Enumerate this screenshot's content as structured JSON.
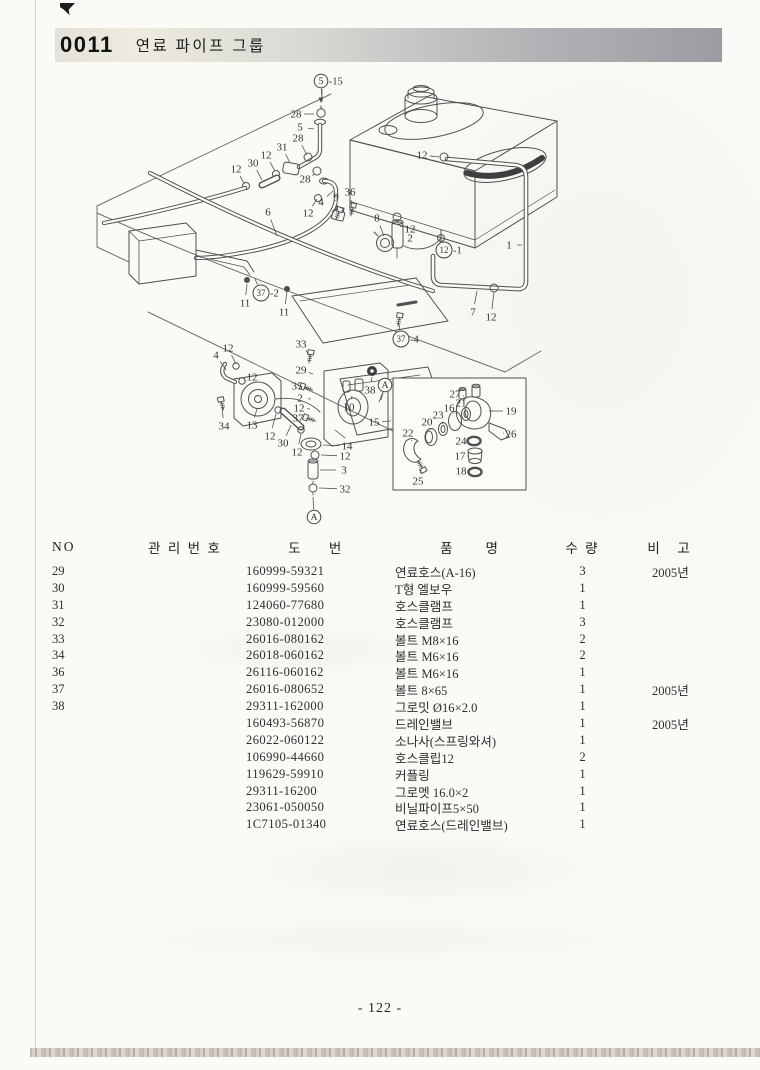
{
  "header": {
    "code": "0011",
    "title": "연료 파이프 그룹"
  },
  "diagram": {
    "description": "fuel-pipe-group-exploded-view",
    "callouts": [
      {
        "t": "28",
        "x": 296,
        "y": 114,
        "lx": 314,
        "ly": 114
      },
      {
        "t": "5",
        "x": 300,
        "y": 127,
        "lx": 314,
        "ly": 129
      },
      {
        "t": "28",
        "x": 298,
        "y": 138,
        "lx": 307,
        "ly": 155
      },
      {
        "t": "31",
        "x": 282,
        "y": 147,
        "lx": 290,
        "ly": 163
      },
      {
        "t": "12",
        "x": 266,
        "y": 155,
        "lx": 275,
        "ly": 171
      },
      {
        "t": "30",
        "x": 253,
        "y": 163,
        "lx": 262,
        "ly": 180
      },
      {
        "t": "12",
        "x": 236,
        "y": 169,
        "lx": 244,
        "ly": 183
      },
      {
        "t": "28",
        "x": 305,
        "y": 179,
        "lx": 315,
        "ly": 174
      },
      {
        "t": "4",
        "x": 321,
        "y": 202,
        "lx": 333,
        "ly": 191
      },
      {
        "t": "12",
        "x": 308,
        "y": 213,
        "lx": 317,
        "ly": 199
      },
      {
        "t": "6",
        "x": 268,
        "y": 212,
        "lx": 277,
        "ly": 236
      },
      {
        "t": "9",
        "x": 336,
        "y": 197,
        "lx": 338,
        "ly": 212
      },
      {
        "t": "36",
        "x": 350,
        "y": 192,
        "lx": 352,
        "ly": 208
      },
      {
        "t": "8",
        "x": 377,
        "y": 218,
        "lx": 384,
        "ly": 236
      },
      {
        "t": "12",
        "x": 422,
        "y": 155,
        "lx": 439,
        "ly": 157
      },
      {
        "t": "12",
        "x": 410,
        "y": 229,
        "lx": 400,
        "ly": 226
      },
      {
        "t": "2",
        "x": 410,
        "y": 238,
        "lx": 402,
        "ly": 238
      },
      {
        "t": "1",
        "x": 509,
        "y": 245,
        "lx": 522,
        "ly": 245
      },
      {
        "t": "7",
        "x": 473,
        "y": 312,
        "lx": 477,
        "ly": 291
      },
      {
        "t": "12",
        "x": 491,
        "y": 317,
        "lx": 494,
        "ly": 292
      },
      {
        "t": "11",
        "x": 245,
        "y": 303,
        "lx": 247,
        "ly": 284
      },
      {
        "t": "11",
        "x": 284,
        "y": 312,
        "lx": 287,
        "ly": 292
      },
      {
        "t": "33",
        "x": 301,
        "y": 344,
        "lx": 310,
        "ly": 356
      },
      {
        "t": "4",
        "x": 216,
        "y": 355,
        "lx": 226,
        "ly": 370
      },
      {
        "t": "12",
        "x": 228,
        "y": 348,
        "lx": 236,
        "ly": 364
      },
      {
        "t": "12",
        "x": 252,
        "y": 377,
        "lx": 244,
        "ly": 381
      },
      {
        "t": "34",
        "x": 224,
        "y": 426,
        "lx": 222,
        "ly": 407
      },
      {
        "t": "13",
        "x": 252,
        "y": 425,
        "lx": 257,
        "ly": 409
      },
      {
        "t": "12",
        "x": 270,
        "y": 436,
        "lx": 276,
        "ly": 414
      },
      {
        "t": "30",
        "x": 283,
        "y": 443,
        "lx": 291,
        "ly": 425
      },
      {
        "t": "12",
        "x": 297,
        "y": 452,
        "lx": 301,
        "ly": 434
      },
      {
        "t": "29",
        "x": 301,
        "y": 370,
        "lx": 313,
        "ly": 374
      },
      {
        "t": "35",
        "x": 297,
        "y": 386,
        "lx": 307,
        "ly": 388
      },
      {
        "t": "2",
        "x": 300,
        "y": 398,
        "lx": 311,
        "ly": 399
      },
      {
        "t": "12",
        "x": 299,
        "y": 408,
        "lx": 310,
        "ly": 409
      },
      {
        "t": "37",
        "x": 298,
        "y": 418,
        "lx": 309,
        "ly": 419
      },
      {
        "t": "38",
        "x": 370,
        "y": 390,
        "lx": 372,
        "ly": 377
      },
      {
        "t": "10",
        "x": 349,
        "y": 407,
        "lx": 352,
        "ly": 396
      },
      {
        "t": "15",
        "x": 374,
        "y": 422,
        "lx": 391,
        "ly": 421
      },
      {
        "t": "14",
        "x": 347,
        "y": 446,
        "lx": 323,
        "ly": 445
      },
      {
        "t": "12",
        "x": 345,
        "y": 456,
        "lx": 321,
        "ly": 455
      },
      {
        "t": "3",
        "x": 344,
        "y": 470,
        "lx": 320,
        "ly": 470
      },
      {
        "t": "32",
        "x": 345,
        "y": 489,
        "lx": 319,
        "ly": 488
      },
      {
        "t": "27",
        "x": 455,
        "y": 394,
        "lx": 464,
        "ly": 396
      },
      {
        "t": "21",
        "x": 461,
        "y": 403,
        "lx": 466,
        "ly": 409
      },
      {
        "t": "16",
        "x": 449,
        "y": 408,
        "lx": 455,
        "ly": 414
      },
      {
        "t": "23",
        "x": 438,
        "y": 415,
        "lx": 443,
        "ly": 424
      },
      {
        "t": "20",
        "x": 427,
        "y": 422,
        "lx": 431,
        "ly": 430
      },
      {
        "t": "22",
        "x": 408,
        "y": 433,
        "lx": 412,
        "ly": 441
      },
      {
        "t": "25",
        "x": 418,
        "y": 481,
        "lx": 421,
        "ly": 470
      },
      {
        "t": "19",
        "x": 511,
        "y": 411,
        "lx": 489,
        "ly": 411
      },
      {
        "t": "26",
        "x": 511,
        "y": 434,
        "lx": 504,
        "ly": 433
      },
      {
        "t": "24",
        "x": 461,
        "y": 441,
        "lx": 467,
        "ly": 441
      },
      {
        "t": "17",
        "x": 460,
        "y": 456,
        "lx": 467,
        "ly": 456
      },
      {
        "t": "18",
        "x": 461,
        "y": 471,
        "lx": 468,
        "ly": 471
      }
    ],
    "ref_markers": [
      {
        "c": "5",
        "s": "-15",
        "x": 321,
        "y": 81,
        "lx": 322,
        "ly": 101
      },
      {
        "c": "12",
        "s": "-1",
        "x": 444,
        "y": 250,
        "lx": 441,
        "ly": 241
      },
      {
        "c": "37",
        "s": "-2",
        "x": 261,
        "y": 293,
        "lx": 255,
        "ly": 279
      },
      {
        "c": "37",
        "s": "-4",
        "x": 401,
        "y": 339,
        "lx": 399,
        "ly": 324
      },
      {
        "c": "A",
        "s": "",
        "x": 314,
        "y": 517,
        "lx": 313,
        "ly": 497
      },
      {
        "c": "A",
        "s": "",
        "x": 385,
        "y": 385,
        "lx": 381,
        "ly": 400
      }
    ]
  },
  "table": {
    "headers": [
      "NO",
      "관 리 번 호",
      "도　　번",
      "품　　명",
      "수 량",
      "비　고"
    ],
    "rows": [
      [
        "29",
        "160999-59321",
        "연료호스(A-16)",
        "3",
        "2005년"
      ],
      [
        "30",
        "160999-59560",
        "T형 엘보우",
        "1",
        ""
      ],
      [
        "31",
        "124060-77680",
        "호스클램프",
        "1",
        ""
      ],
      [
        "32",
        "23080-012000",
        "호스클램프",
        "3",
        ""
      ],
      [
        "33",
        "26016-080162",
        "볼트 M8×16",
        "2",
        ""
      ],
      [
        "34",
        "26018-060162",
        "볼트 M6×16",
        "2",
        ""
      ],
      [
        "36",
        "26116-060162",
        "볼트 M6×16",
        "1",
        ""
      ],
      [
        "37",
        "26016-080652",
        "볼트 8×65",
        "1",
        "2005년"
      ],
      [
        "38",
        "29311-162000",
        "그로밋 Ø16×2.0",
        "1",
        ""
      ],
      [
        "",
        "160493-56870",
        "드레인밸브",
        "1",
        "2005년"
      ],
      [
        "",
        "26022-060122",
        "소나사(스프링와셔)",
        "1",
        ""
      ],
      [
        "",
        "106990-44660",
        "호스클립12",
        "2",
        ""
      ],
      [
        "",
        "119629-59910",
        "커플링",
        "1",
        ""
      ],
      [
        "",
        "29311-16200",
        "그로멧 16.0×2",
        "1",
        ""
      ],
      [
        "",
        "23061-050050",
        "비닐파이프5×50",
        "1",
        ""
      ],
      [
        "",
        "1C7105-01340",
        "연료호스(드레인밸브)",
        "1",
        ""
      ]
    ]
  },
  "footer": {
    "page_number": "- 122 -"
  }
}
